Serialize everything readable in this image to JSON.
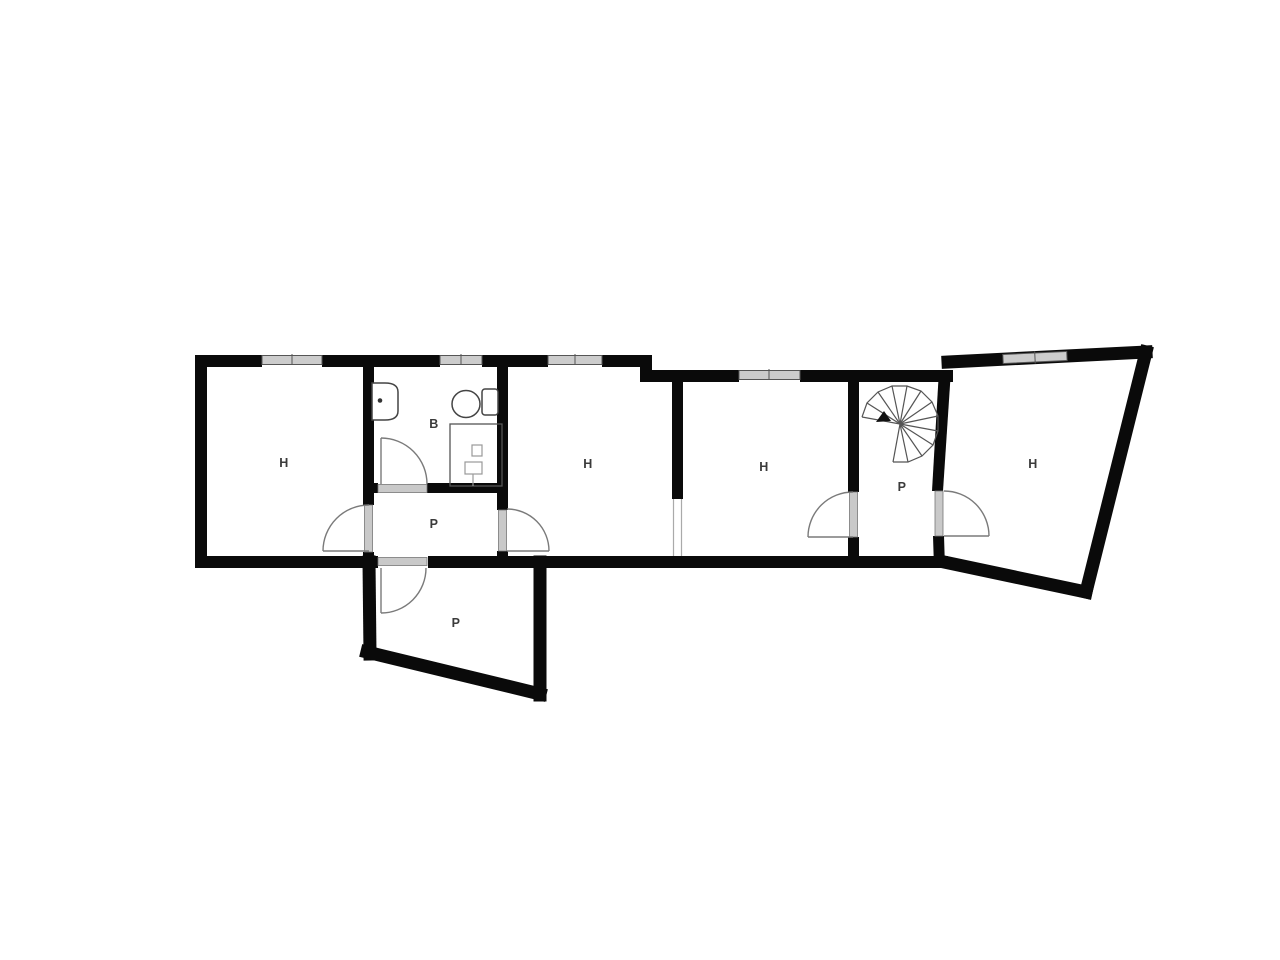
{
  "title": "Single floor plan drawing",
  "rooms": [
    {
      "id": "room-h-left",
      "label": "H"
    },
    {
      "id": "room-b-bath",
      "label": "B"
    },
    {
      "id": "hall-p-center",
      "label": "P"
    },
    {
      "id": "room-h-middle",
      "label": "H"
    },
    {
      "id": "room-h-third",
      "label": "H"
    },
    {
      "id": "stair-p",
      "label": "P"
    },
    {
      "id": "room-h-right",
      "label": "H"
    },
    {
      "id": "room-p-bottom",
      "label": "P"
    }
  ],
  "icons": [
    {
      "name": "sink-icon"
    },
    {
      "name": "toilet-icon"
    },
    {
      "name": "shower-icon"
    },
    {
      "name": "spiral-staircase-icon"
    },
    {
      "name": "door-swing-icon"
    },
    {
      "name": "window-icon"
    }
  ],
  "colors": {
    "wall": "#0a0a0a",
    "background": "#ffffff",
    "label_text": "#3b3b3b",
    "door_line": "#7a7a7a",
    "threshold_fill": "#c9c9c9",
    "window_fill": "#cccccc",
    "window_stroke": "#555555",
    "fixture_stroke": "#444444",
    "stair_stroke": "#555555"
  }
}
